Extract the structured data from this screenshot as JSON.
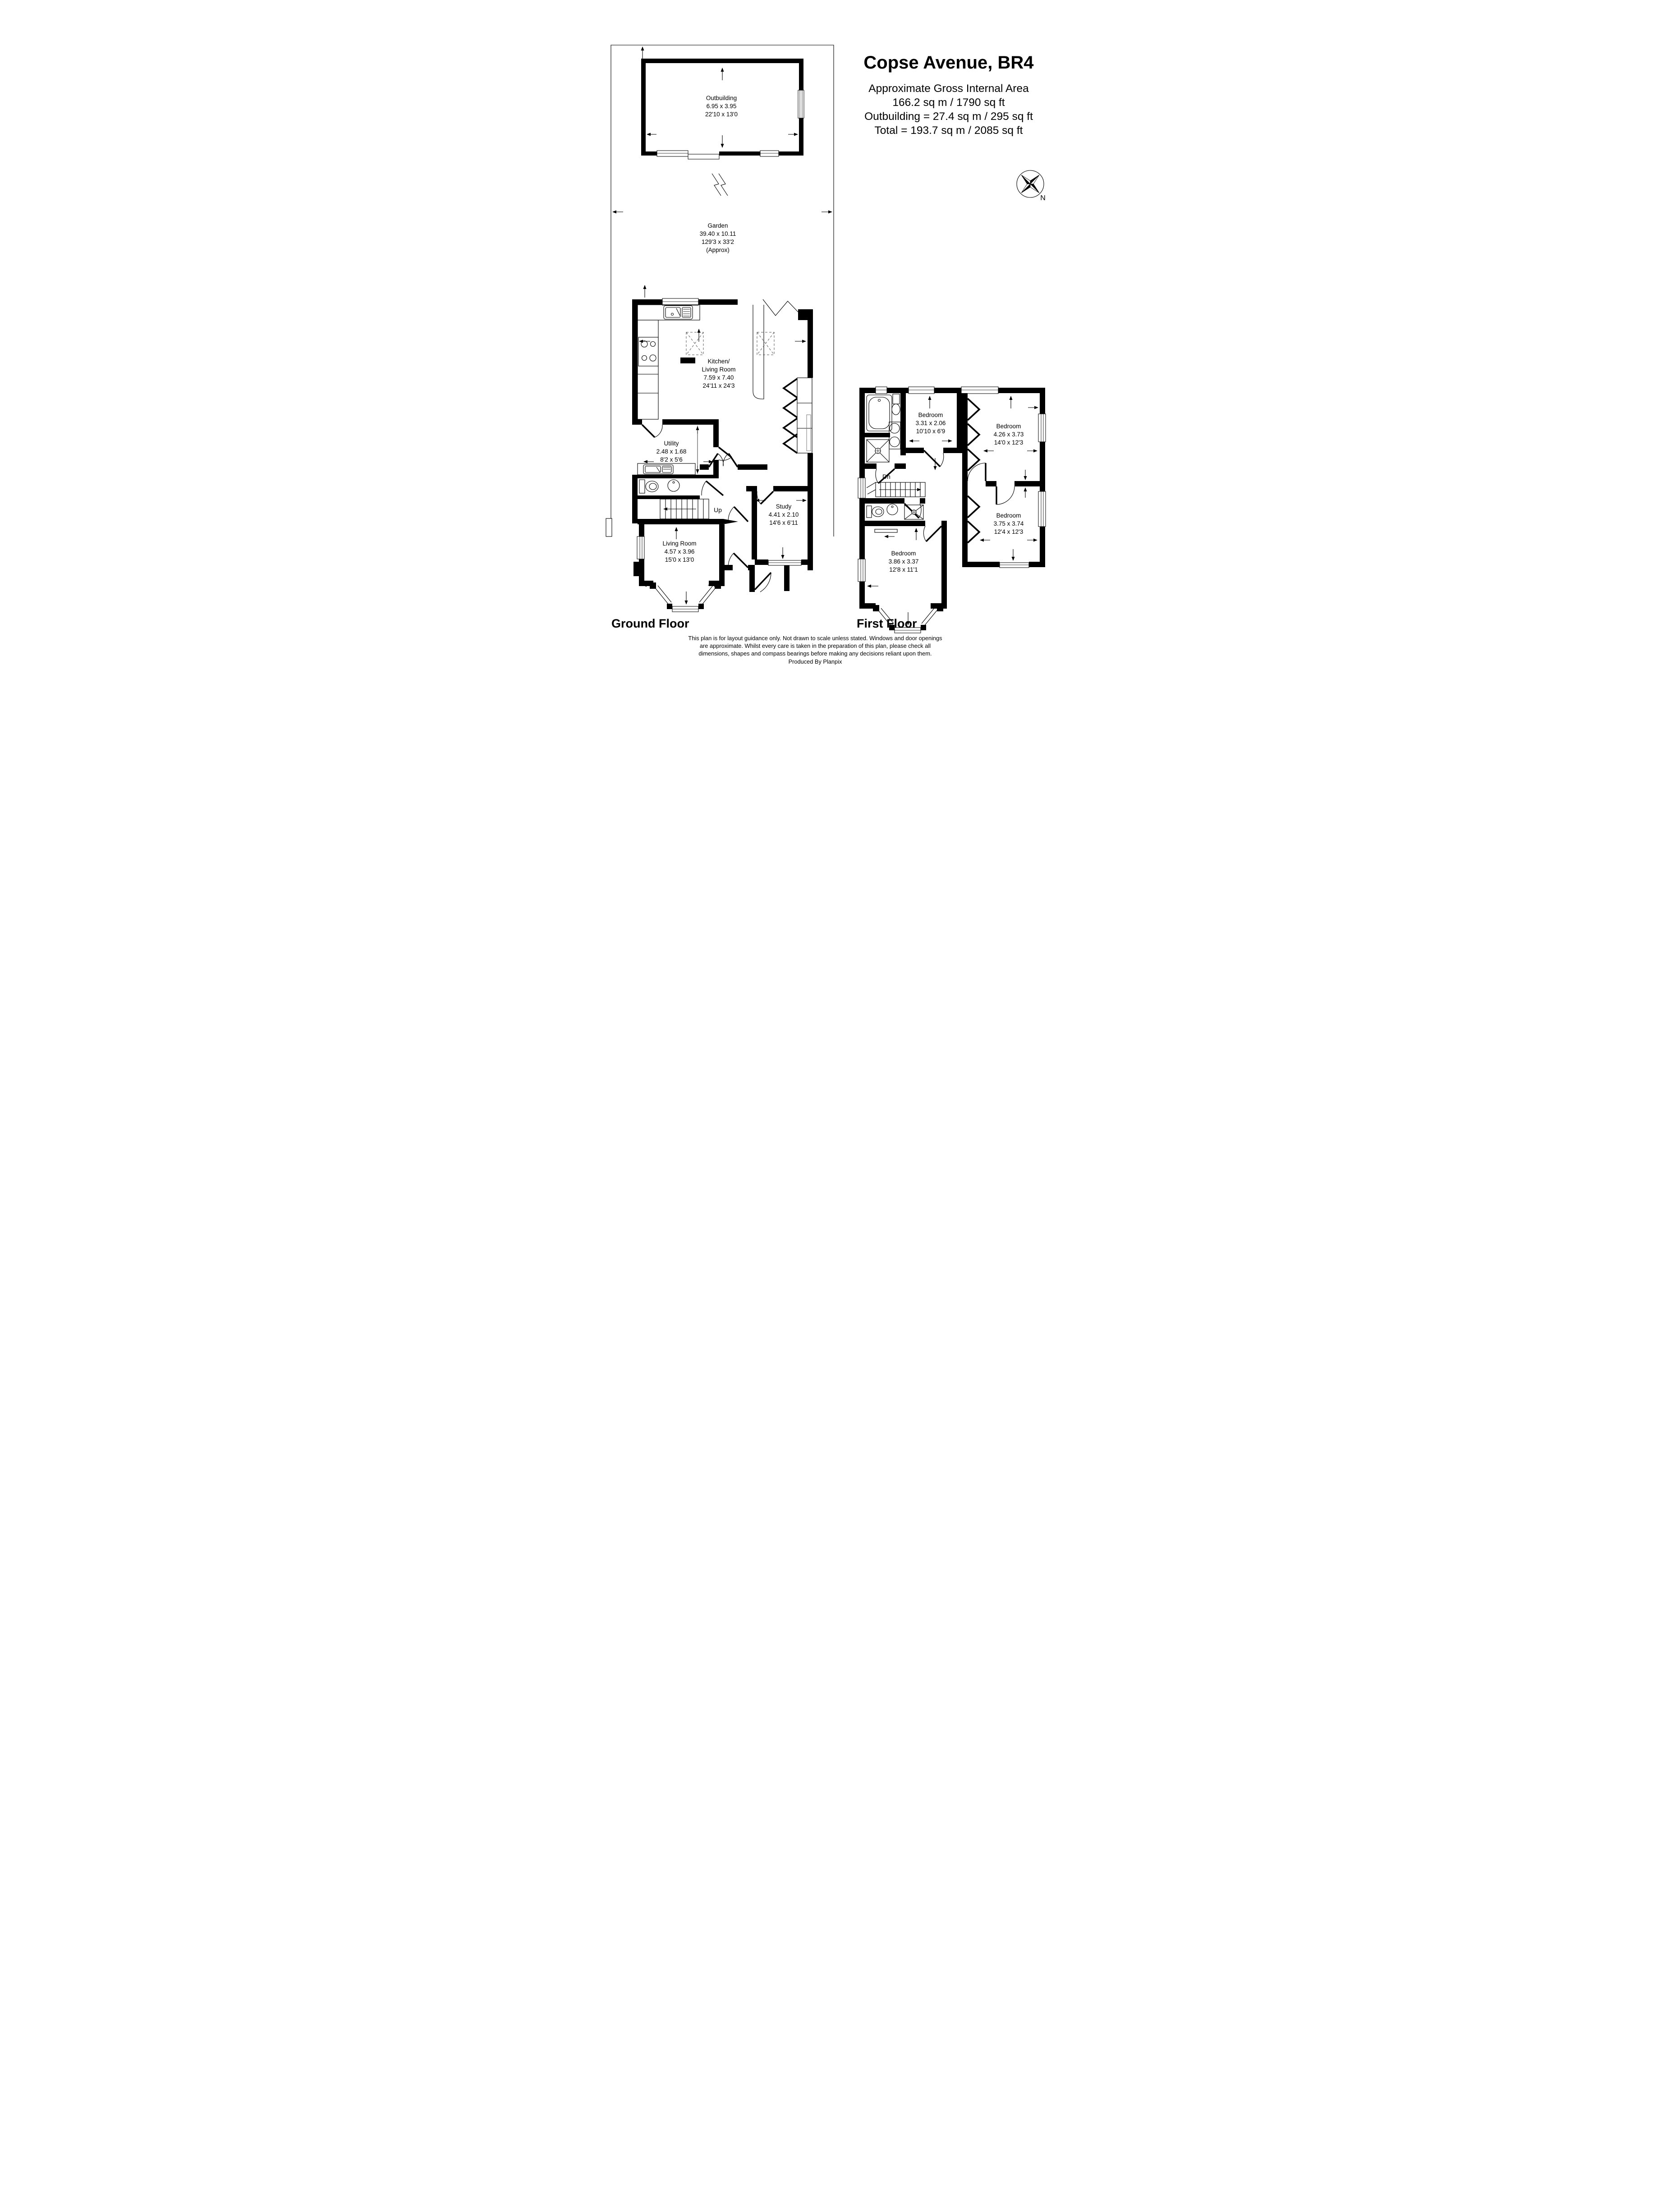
{
  "title_block": {
    "title": "Copse Avenue, BR4",
    "line1": "Approximate Gross Internal Area",
    "line2": "166.2 sq m / 1790 sq ft",
    "line3": "Outbuilding = 27.4 sq m / 295 sq ft",
    "line4": "Total = 193.7 sq m / 2085 sq ft"
  },
  "compass": {
    "label": "N"
  },
  "garden": {
    "name": "Garden",
    "dims_m": "39.40 x 10.11",
    "dims_ft": "129'3 x 33'2",
    "approx": "(Approx)"
  },
  "outbuilding": {
    "name": "Outbuilding",
    "dims_m": "6.95 x 3.95",
    "dims_ft": "22'10 x 13'0"
  },
  "ground_floor": {
    "label": "Ground Floor",
    "rooms": {
      "kitchen": {
        "name1": "Kitchen/",
        "name2": "Living Room",
        "dims_m": "7.59 x 7.40",
        "dims_ft": "24'11 x 24'3"
      },
      "utility": {
        "name": "Utility",
        "dims_m": "2.48 x 1.68",
        "dims_ft": "8'2 x 5'6"
      },
      "living_room": {
        "name": "Living Room",
        "dims_m": "4.57 x 3.96",
        "dims_ft": "15'0 x 13'0"
      },
      "study": {
        "name": "Study",
        "dims_m": "4.41 x 2.10",
        "dims_ft": "14'6 x 6'11"
      },
      "stairs": {
        "label": "Up"
      }
    }
  },
  "first_floor": {
    "label": "First Floor",
    "rooms": {
      "bedroom1": {
        "name": "Bedroom",
        "dims_m": "3.31 x 2.06",
        "dims_ft": "10'10 x 6'9"
      },
      "bedroom2": {
        "name": "Bedroom",
        "dims_m": "4.26 x 3.73",
        "dims_ft": "14'0 x 12'3"
      },
      "bedroom3": {
        "name": "Bedroom",
        "dims_m": "3.75 x 3.74",
        "dims_ft": "12'4 x 12'3"
      },
      "bedroom4": {
        "name": "Bedroom",
        "dims_m": "3.86 x 3.37",
        "dims_ft": "12'8 x 11'1"
      },
      "stairs": {
        "label": "Dn"
      }
    }
  },
  "footer": {
    "disclaimer_line1": "This plan is for layout guidance only. Not drawn to scale unless stated. Windows and door openings",
    "disclaimer_line2": "are approximate. Whilst every care is taken in the preparation of this plan, please check all",
    "disclaimer_line3": "dimensions, shapes and compass bearings before making any decisions reliant upon them.",
    "disclaimer_line4": "Produced By Planpix"
  },
  "colors": {
    "wall": "#000000",
    "background": "#ffffff"
  }
}
